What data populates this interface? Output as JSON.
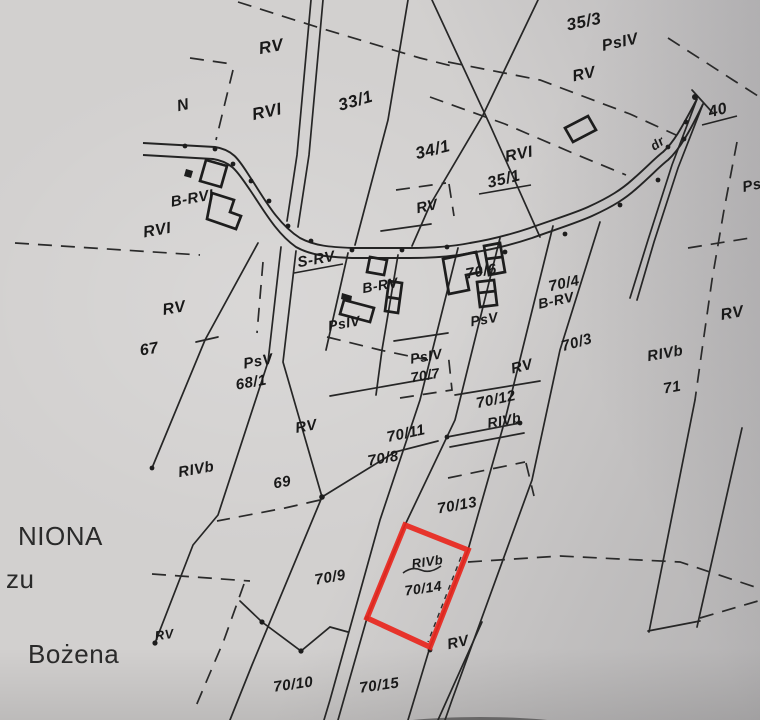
{
  "document": {
    "type_note": "scanned cadastral map sheet",
    "margin_text": {
      "fragment_top": "NIONA",
      "fragment_middle": "zu",
      "name_bottom": "Bożena"
    },
    "highlight": {
      "highlighted_parcel": "70/14",
      "highlight_color": "#e8281f"
    }
  },
  "labels": {
    "parcels": {
      "p33_1": "33/1",
      "p34_1": "34/1",
      "p35_1": "35/1",
      "p35_3": "35/3",
      "p40": "40",
      "p67": "67",
      "p68_1": "68/1",
      "p69": "69",
      "p71": "71",
      "p70_3": "70/3",
      "p70_4": "70/4",
      "p70_6": "70/6",
      "p70_7": "70/7",
      "p70_8": "70/8",
      "p70_9": "70/9",
      "p70_10": "70/10",
      "p70_11": "70/11",
      "p70_12": "70/12",
      "p70_13": "70/13",
      "p70_14": "70/14",
      "p70_15": "70/15"
    },
    "land_classes": {
      "n_area": "N",
      "rv_nw": "RV",
      "rvi_nw": "RVI",
      "rvi_w": "RVI",
      "b_rvi": "B-RVI",
      "psiv_ne": "PsIV",
      "rv_ne": "RV",
      "rvi_c": "RVI",
      "rv_box": "RV",
      "ps_e": "Ps",
      "s_rv": "S-RV",
      "b_rv_w": "B-RV",
      "b_rv_e": "B-RV",
      "psiv_w": "PsIV",
      "psv_c": "PsV",
      "rv_67": "RV",
      "psv_68": "PsV",
      "psiv_70_7": "PsIV",
      "rv_70_12": "RV",
      "rivb_71": "RIVb",
      "rv_e": "RV",
      "rivb_70_12": "RIVb",
      "rv_69": "RV",
      "rivb_w": "RIVb",
      "rivb_70_14": "RIVb",
      "rv_sw": "RV",
      "rv_s": "RV",
      "road_abbr": "dr"
    }
  }
}
